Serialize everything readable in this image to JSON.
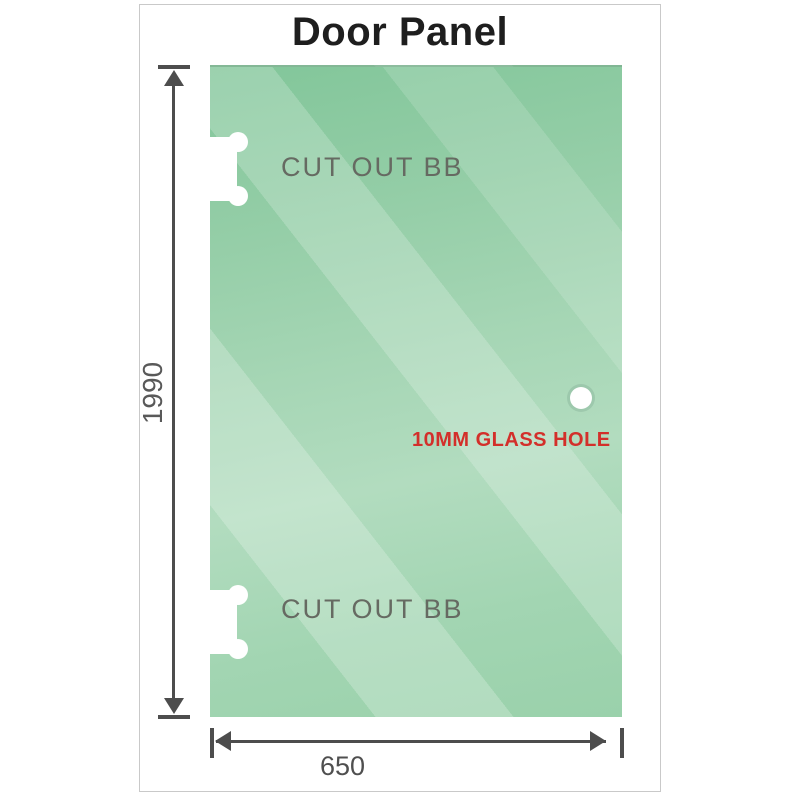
{
  "diagram": {
    "title": "Door Panel",
    "panel": {
      "height_label": "1990",
      "width_label": "650",
      "cutout_top_label": "CUT OUT BB",
      "cutout_bottom_label": "CUT OUT BB",
      "hole_label": "10MM GLASS HOLE"
    },
    "colors": {
      "glass_base": "#94cda7",
      "glass_highlight": "#b2dcbf",
      "dimension_lines": "#4d4d4d",
      "cutout_label_gray": "#666a62",
      "hole_label_red": "#d32f2a",
      "title_color": "#1e1e1e",
      "border_gray": "#c9c9c9"
    }
  }
}
